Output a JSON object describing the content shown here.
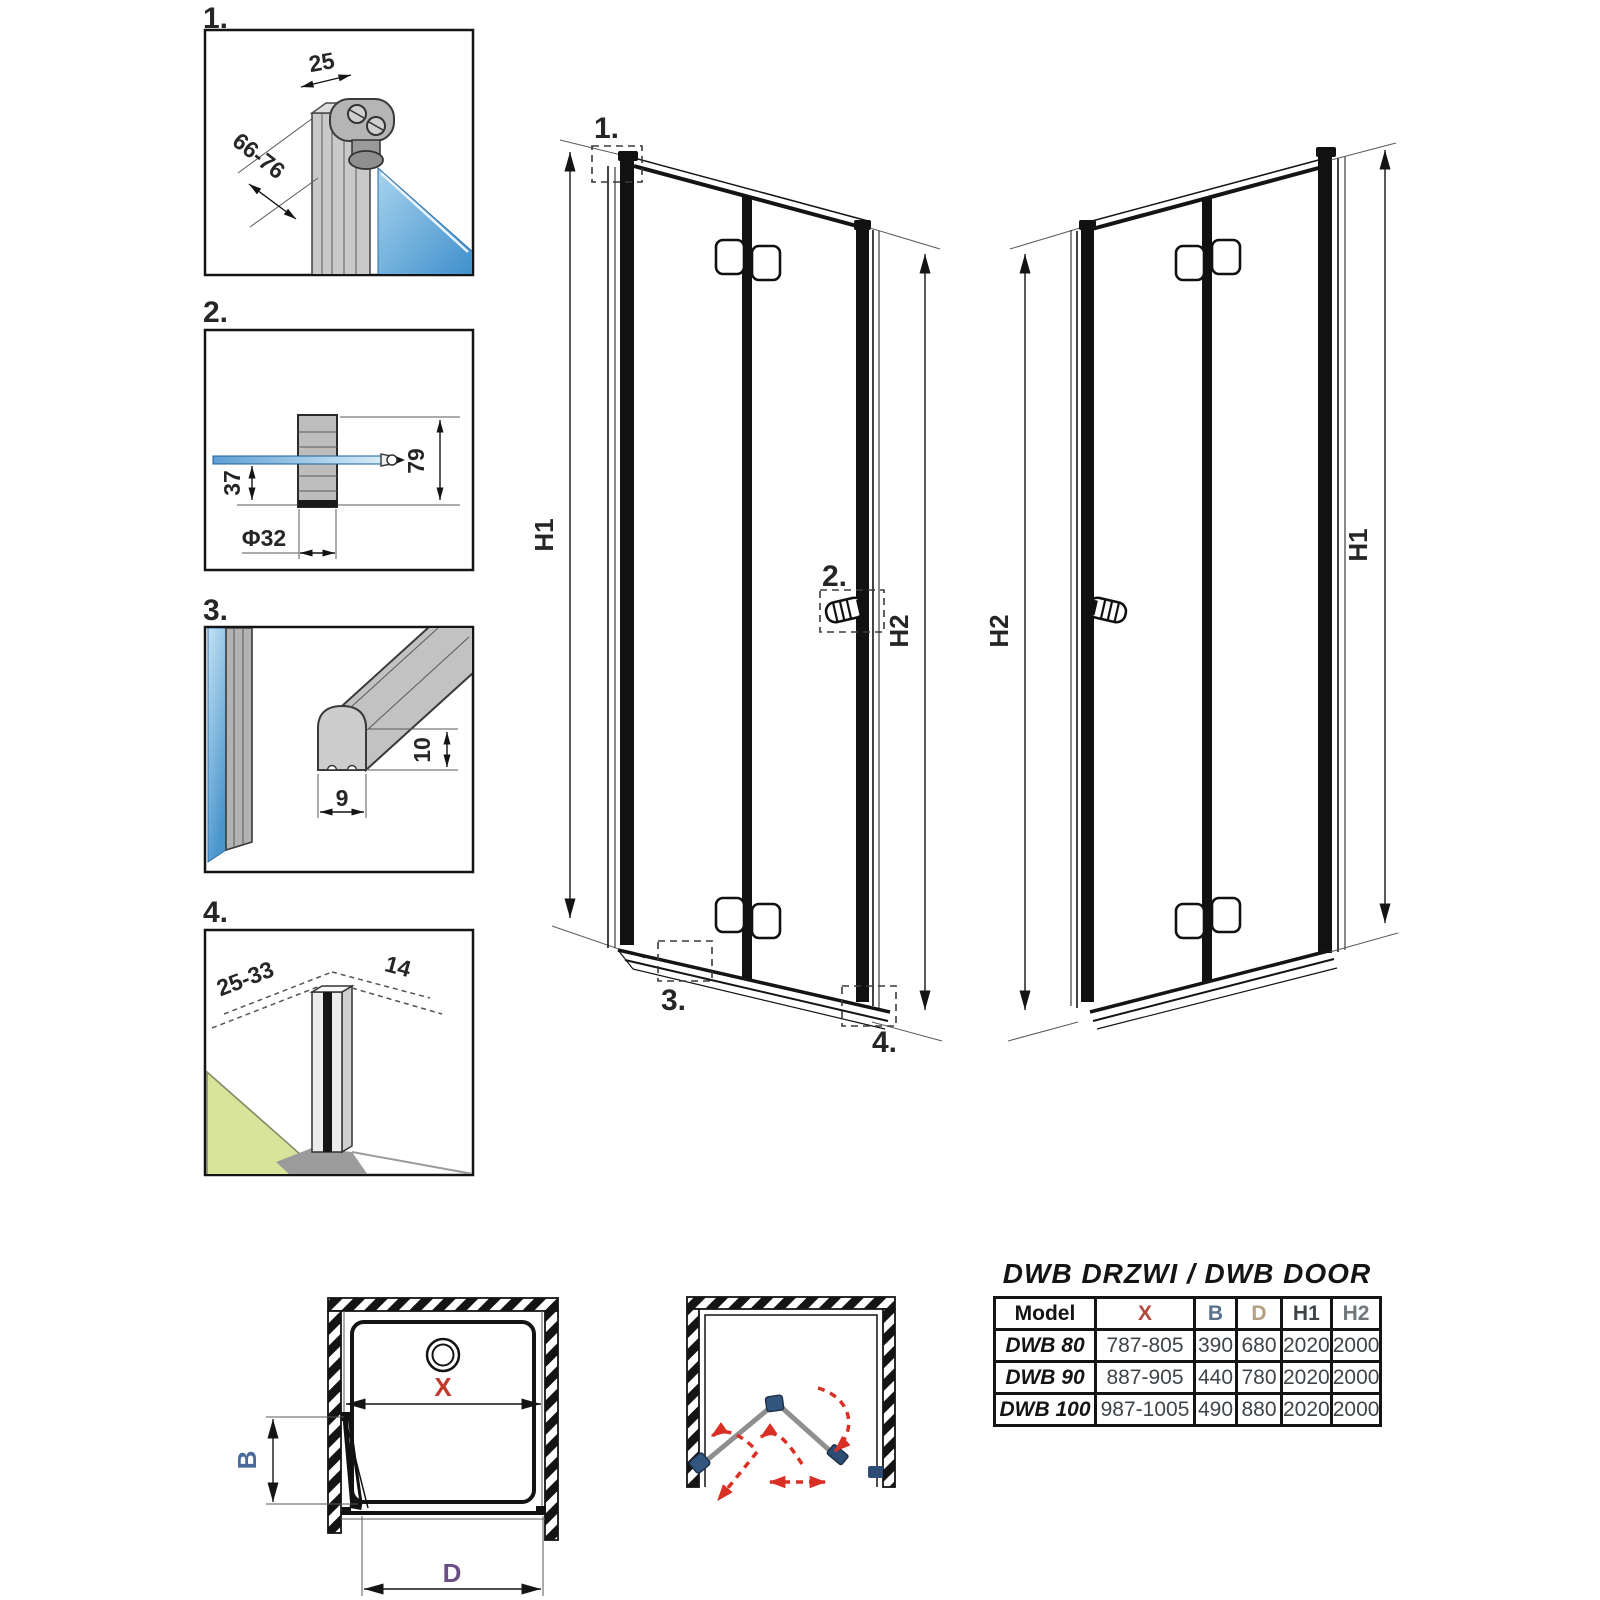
{
  "callout_labels": {
    "c1": "1.",
    "c2": "2.",
    "c3": "3.",
    "c4": "4."
  },
  "detail_dims": {
    "profile_width": "25",
    "profile_depth_range": "66-76",
    "knob_total_height": "79",
    "knob_glass_offset": "37",
    "knob_diameter": "Φ32",
    "seal_height": "10",
    "seal_width": "9",
    "bottom_profile_depth_range": "25-33",
    "bottom_profile_width": "14"
  },
  "elevation_dims": {
    "h1": "H1",
    "h2": "H2"
  },
  "plan_dims": {
    "x": "X",
    "b": "B",
    "d": "D"
  },
  "table": {
    "title": "DWB DRZWI / DWB DOOR",
    "headers": [
      "Model",
      "X",
      "B",
      "D",
      "H1",
      "H2"
    ],
    "rows": [
      [
        "DWB 80",
        "787-805",
        "390",
        "680",
        "2020",
        "2000"
      ],
      [
        "DWB 90",
        "887-905",
        "440",
        "780",
        "2020",
        "2000"
      ],
      [
        "DWB 100",
        "987-1005",
        "490",
        "880",
        "2020",
        "2000"
      ]
    ]
  },
  "colors": {
    "line": "#141414",
    "dim_x_red": "#c0392b",
    "dim_b_blue": "#4a6b9a",
    "dim_d_purple": "#6b4e84",
    "header_x": "#b5483f",
    "header_b": "#5a708c",
    "header_d": "#b3a081",
    "header_h1": "#3d4347",
    "header_h2": "#70787e",
    "glass_blue": "#4a95cc",
    "floor_green": "#d9e49b",
    "hinge_blue": "#33567f",
    "swing_arrow_red": "#d93025"
  }
}
